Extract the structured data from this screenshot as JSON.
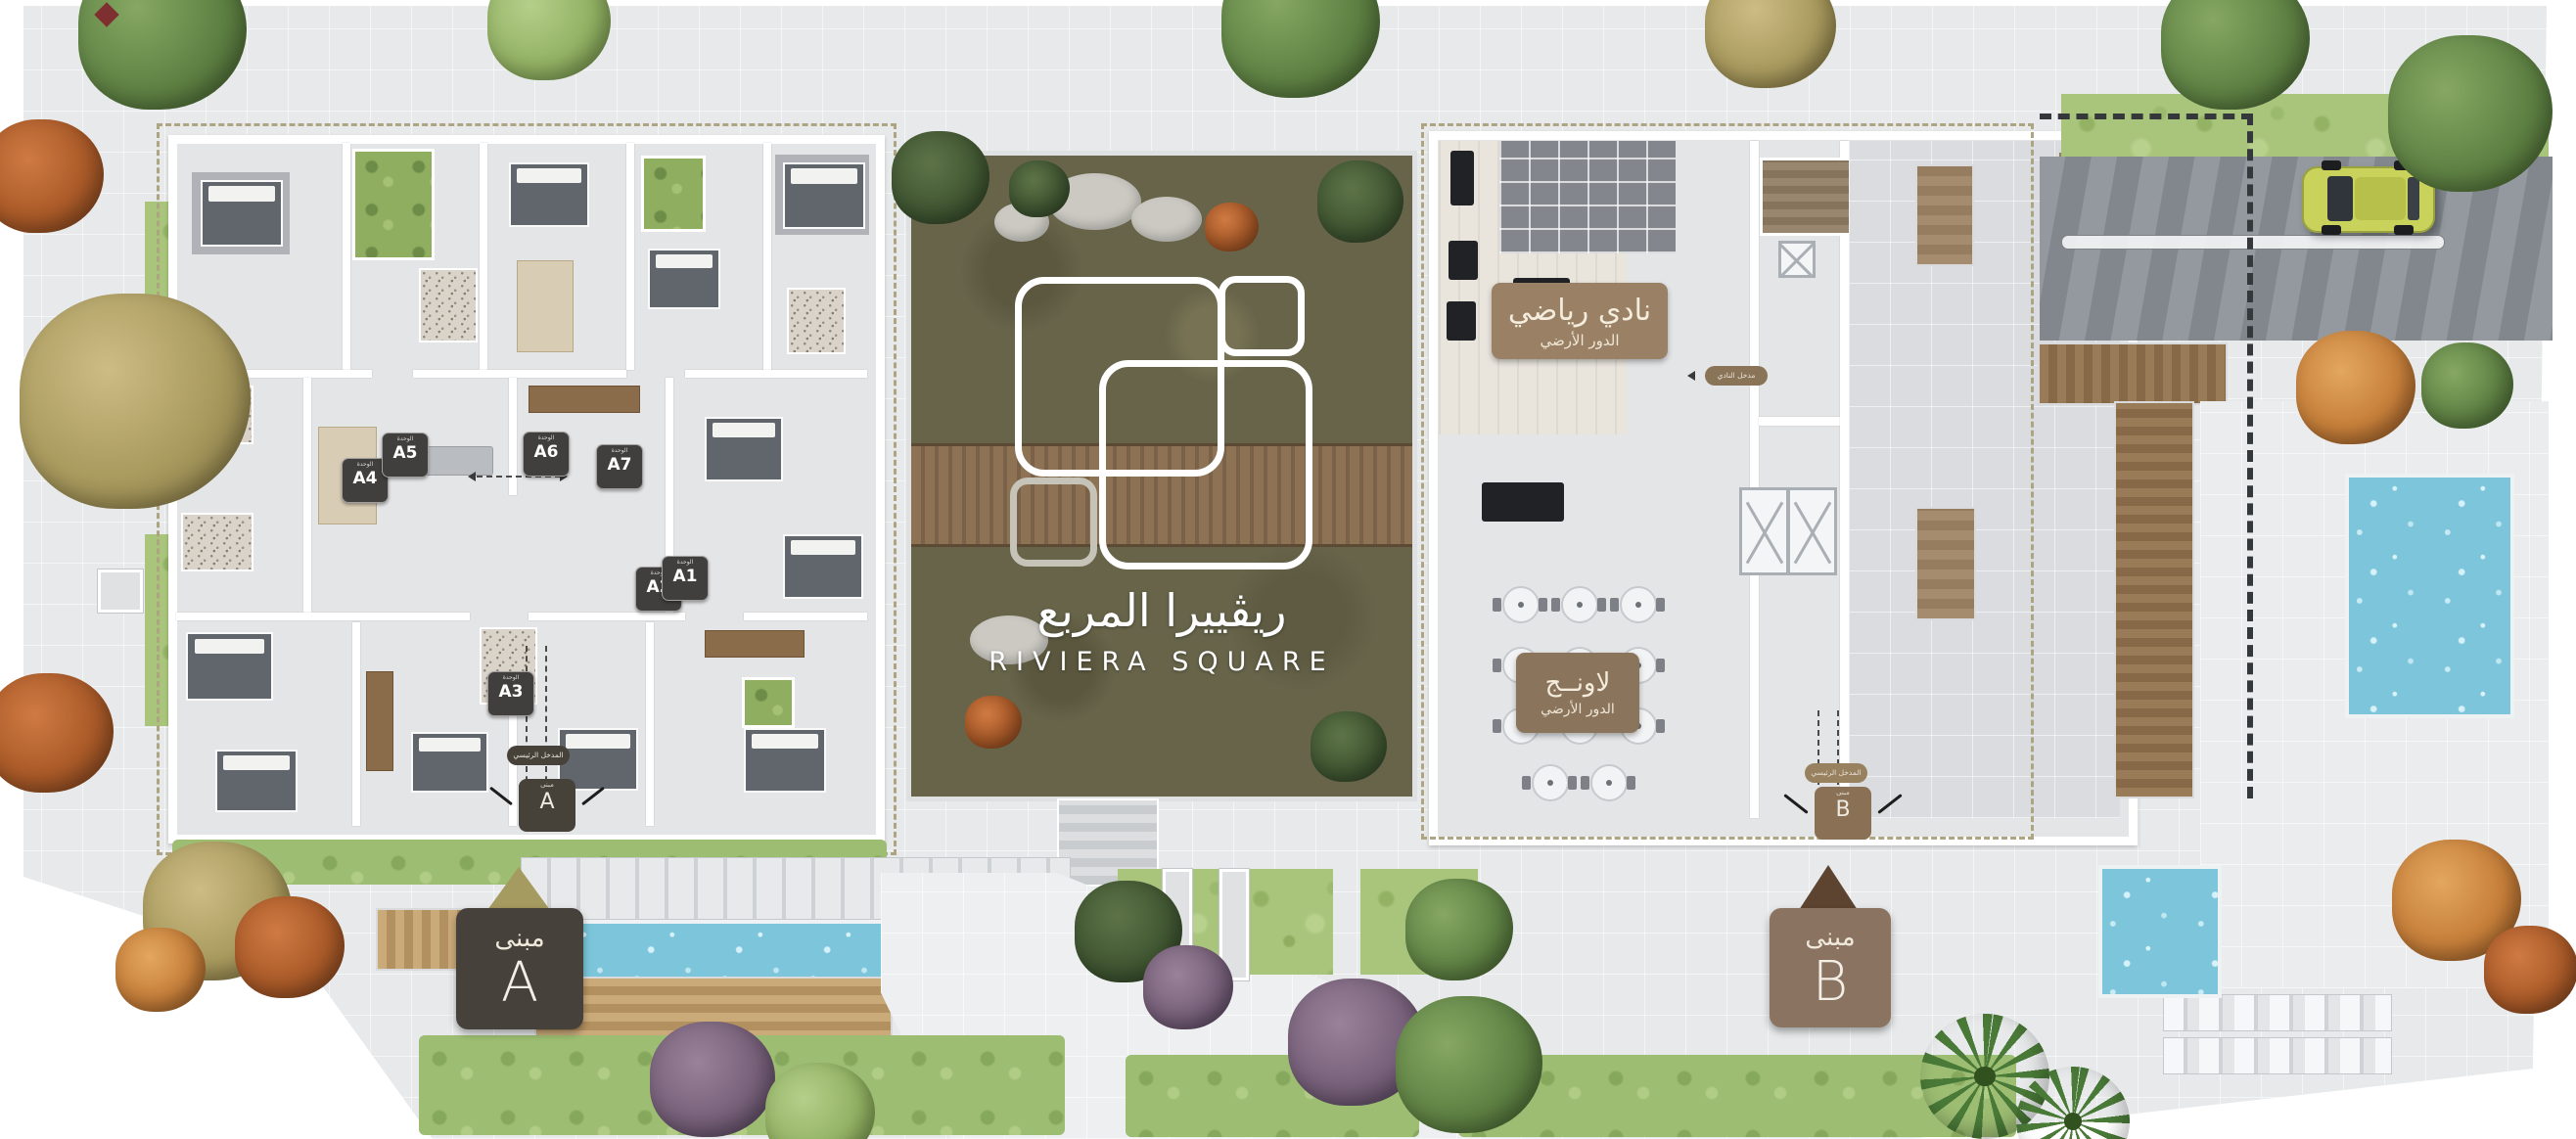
{
  "project": {
    "title_ar": "ريڤييرا المربع",
    "title_en": "RIVIERA SQUARE"
  },
  "building_a": {
    "marker": {
      "prefix": "مبنى",
      "letter": "A"
    },
    "entrance": {
      "pill_label": "المدخل الرئيسي",
      "badge_caption": "مبنى",
      "badge_letter": "A"
    },
    "unit_caption": "الوحدة",
    "units": [
      "A1",
      "A2",
      "A3",
      "A4",
      "A5",
      "A6",
      "A7"
    ]
  },
  "building_b": {
    "marker": {
      "prefix": "مبنى",
      "letter": "B"
    },
    "entrance": {
      "pill_label": "المدخل الرئيسي",
      "badge_caption": "مبنى",
      "badge_letter": "B"
    },
    "club": {
      "name": "نادي رياضي",
      "floor": "الدور الأرضي"
    },
    "lounge": {
      "name": "لاونــج",
      "floor": "الدور الأرضي"
    },
    "club_entrance": "مدخل النادي"
  },
  "colors": {
    "courtyard_green": "#67644a",
    "label_brown": "#9a8166",
    "marker_a_bg": "#46413b",
    "marker_b_bg": "#8a7360",
    "pointer_gold": "#a59a5f",
    "pointer_brown": "#5d4430",
    "water_blue": "#7cc5da",
    "unit_badge_dark": "#403f3d",
    "car_yellow": "#c9d35b"
  }
}
